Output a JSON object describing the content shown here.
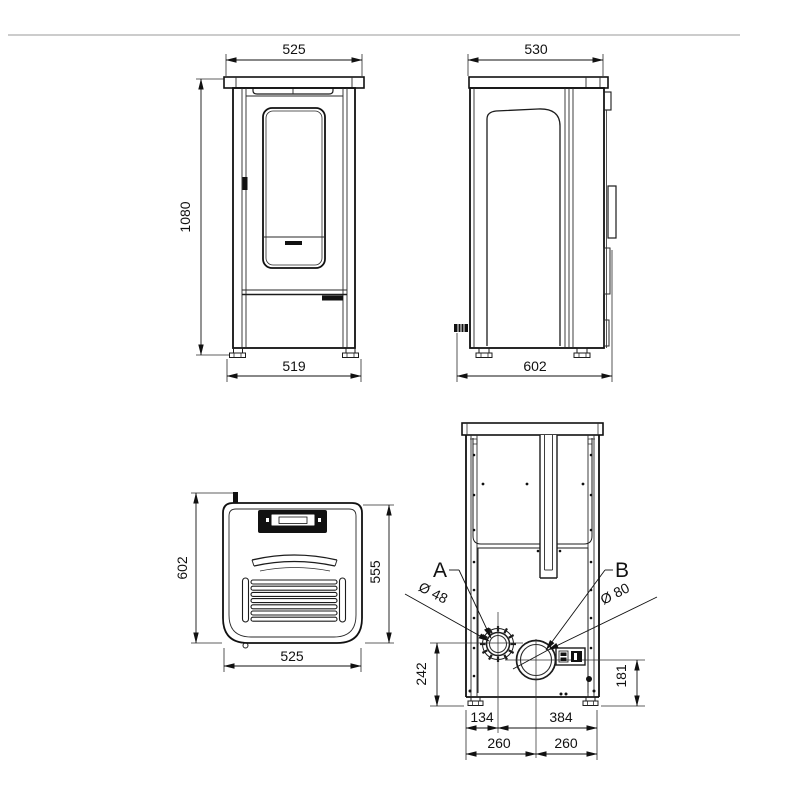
{
  "page": {
    "background": "#ffffff",
    "divider_color": "#aeaeae",
    "line_color": "#111111"
  },
  "views": {
    "front": {
      "width_top": "525",
      "height": "1080",
      "width_bottom": "519"
    },
    "side": {
      "width_top": "530",
      "depth_bottom": "602"
    },
    "top": {
      "depth_total": "602",
      "depth_body": "555",
      "width": "525"
    },
    "rear": {
      "label_a": "A",
      "label_b": "B",
      "dia_a": "Ø 48",
      "dia_b": "Ø 80",
      "height_a": "242",
      "height_b": "181",
      "a_from_left": "134",
      "a_to_right": "384",
      "b_from_left": "260",
      "b_to_right": "260"
    }
  }
}
